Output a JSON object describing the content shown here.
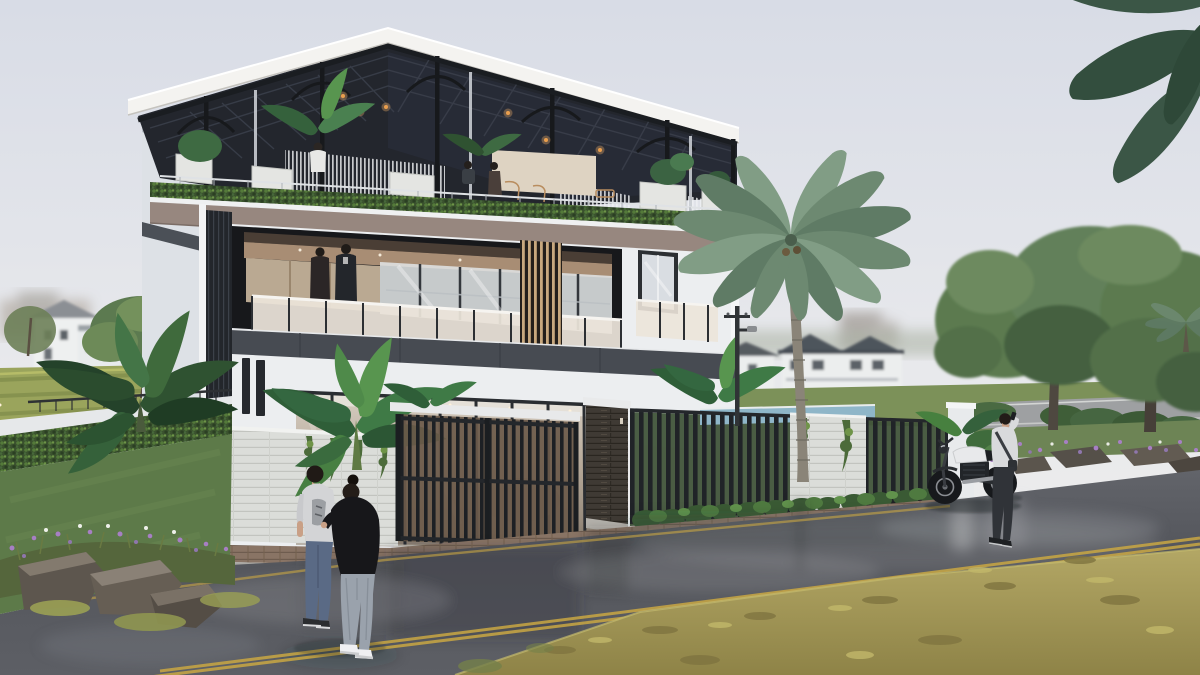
{
  "meta": {
    "title": "Modern three-storey villa — exterior architectural rendering",
    "style": "photorealistic 3D archviz, overcast sky after rain, wet street",
    "camera": "street-level three-quarter view from front-left"
  },
  "palette": {
    "sky_top": "#d9dde6",
    "sky_bottom": "#efeeed",
    "wall": "#eceef0",
    "wall_shade": "#dde1e6",
    "charcoal": "#474b52",
    "frame_dark": "#34383f",
    "taupe": "#97877f",
    "roof_dark": "#23262d",
    "steel": "#1a1d21",
    "fascia_white": "#f4f3f0",
    "wood_ceiling": "#a88d74",
    "wood_slat": "#c8a87e",
    "glass_warm": "#ece4d9",
    "interior_warm": "#cfc5b8",
    "hedge": "#3a512e",
    "lawn": "#5d7a49",
    "field_yellow_green": "#9aa45c",
    "tree": "#5c7a50",
    "tree_dark": "#45613f",
    "palm": "#6d8971",
    "gate_dark": "#1e2125",
    "stone_dark": "#403b35",
    "stone_light": "#dbddd9",
    "brick_sidewalk": "#8a7264",
    "road_wet": "#55575d",
    "road_light": "#9a9ca0",
    "grass_dry": "#a4985a",
    "pool_blue": "#8fb6c8",
    "flower_purple": "#a77fc4",
    "lane_yellow": "#c9a743",
    "string_light_orange": "#e8973f",
    "skin": "#c9a086",
    "denim_blue": "#5a6a85",
    "denim_gray": "#9aa2ac",
    "people_dark": "#1b1b20",
    "sweater_light": "#d9dadc"
  },
  "scene": {
    "building": {
      "floors": 3,
      "features": [
        "steel pergola canopy roof with dark panels and arched braces",
        "rooftop terrace with hedge parapet, planters, seated guests and hanging slat curtains",
        "second-floor recessed balcony with frosted glass railing and wood-slat screen",
        "two people standing on the balcony",
        "ground floor full-height glazing behind a slatted sliding gate",
        "dark stacked-stone gate pillar",
        "black vertical-slat perimeter fence with white stone section and climbing vines",
        "glimpse of blue pool water behind the fence"
      ]
    },
    "vegetation": [
      "tall coconut palm in front of the fence",
      "banana plant against the front wall",
      "tropical broadleaf plant on the left boundary",
      "clipped hedge and green lawn on the left",
      "large street trees on the right",
      "palm fronds entering the top-right corner",
      "purple and white flower beds with boulders"
    ],
    "people": [
      "couple walking on the wet road in the left foreground",
      "man in light sweater talking on a phone beside a motorcycle",
      "couple standing at the balcony railing",
      "guests seated on the rooftop terrace"
    ],
    "vehicles": [
      "black and white naked motorcycle parked at the curb"
    ],
    "street": [
      "wet asphalt with sky reflections",
      "double yellow centre line and yellow edge line",
      "brick sidewalk strip and kerb",
      "dry yellow-green grass verge in the near right foreground",
      "utility pole with street lamp",
      "white neighbourhood houses with dark tiled roofs in the distance"
    ]
  }
}
